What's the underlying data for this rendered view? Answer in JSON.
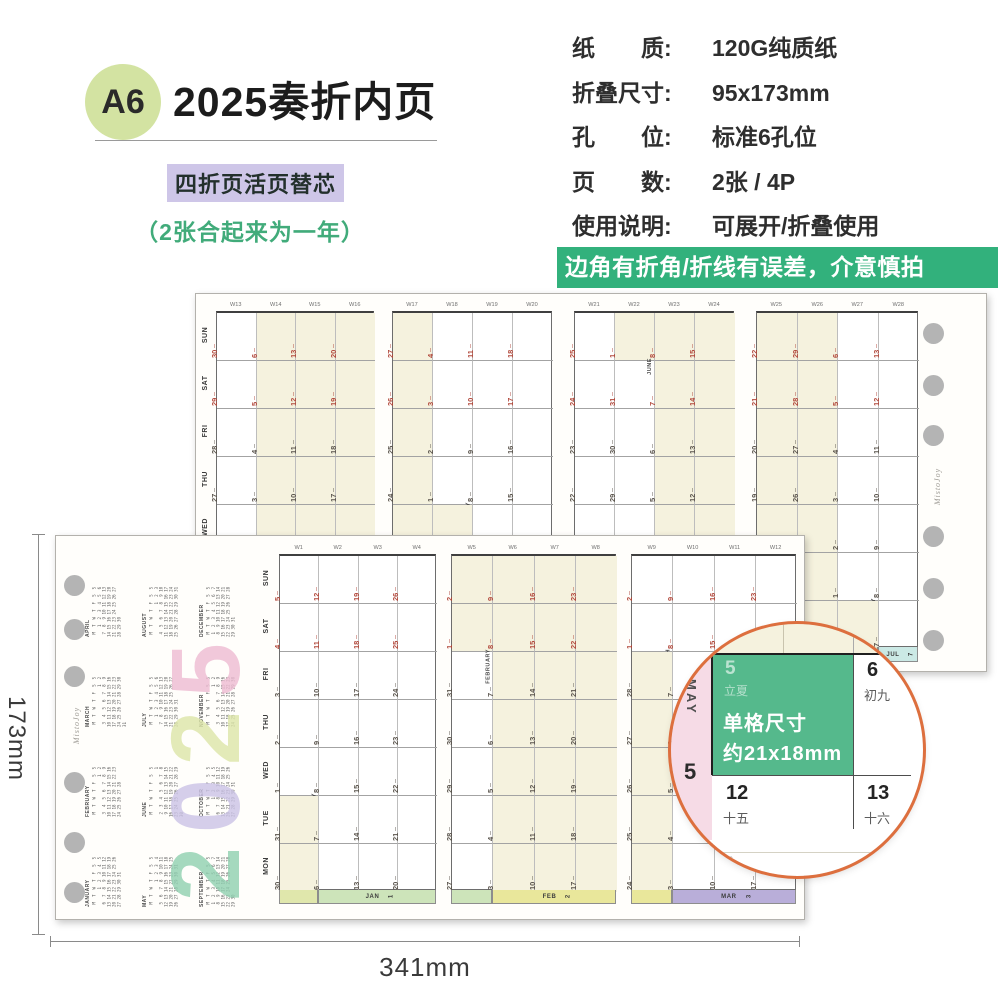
{
  "header": {
    "badge": "A6",
    "badge_bg": "#d3e3a2",
    "title": "2025奏折内页",
    "subtitle": "四折页活页替芯",
    "subtitle_bg": "#cec6e8",
    "note": "（2张合起来为一年）",
    "note_color": "#41ab7a"
  },
  "specs": {
    "rows": [
      {
        "label": "纸　　质:",
        "value": "120G纯质纸"
      },
      {
        "label": "折叠尺寸:",
        "value": "95x173mm"
      },
      {
        "label": "孔　　位:",
        "value": "标准6孔位"
      },
      {
        "label": "页　　数:",
        "value": "2张 / 4P"
      },
      {
        "label": "使用说明:",
        "value": "可展开/折叠使用"
      }
    ],
    "warning": "边角有折角/折线有误差，介意慎拍",
    "warning_bg": "#32b17c"
  },
  "dimensions": {
    "width": "341mm",
    "height": "173mm"
  },
  "brand": "MistoJoy",
  "calendar": {
    "year": 2025,
    "day_rows": [
      "SUN",
      "SAT",
      "FRI",
      "THU",
      "WED",
      "TUE",
      "MON"
    ],
    "month_names": [
      "JANUARY",
      "FEBRUARY",
      "MARCH",
      "APRIL",
      "MAY",
      "JUNE",
      "JULY",
      "AUGUST",
      "SEPTEMBER",
      "OCTOBER",
      "NOVEMBER",
      "DECEMBER"
    ],
    "month_abbr": [
      "JAN",
      "FEB",
      "MAR",
      "APR",
      "MAY",
      "JUN",
      "JUL",
      "AUG",
      "SEP",
      "OCT",
      "NOV",
      "DEC"
    ],
    "weekday_letters": [
      "M",
      "T",
      "W",
      "T",
      "F",
      "S",
      "S"
    ],
    "back_sheet": {
      "week_start": 13,
      "week_end": 28
    },
    "front_sheet": {
      "week_start": 1,
      "week_end": 12
    },
    "band_colors": {
      "JAN": "#cde4ba",
      "FEB": "#e9e79b",
      "MAR": "#b9aed9",
      "APR": "#f0e0c0",
      "MAY": "#f3d4e2",
      "JUN": "#d8e9cc",
      "JUL": "#cbe9e5",
      "AUG": "#f3e0c8",
      "SEP": "#cfe3d8",
      "OCT": "#cec6e8",
      "NOV": "#e4e9c2",
      "DEC": "#e0e7ac"
    },
    "cream": "#f5f2de",
    "date_red": "#b2483b",
    "date_dark": "#5a544c",
    "year_digits": [
      {
        "char": "2",
        "color": "#8fd0b0"
      },
      {
        "char": "0",
        "color": "#cbc3e6"
      },
      {
        "char": "2",
        "color": "#dde6a8"
      },
      {
        "char": "5",
        "color": "#eebbd2"
      }
    ]
  },
  "magnifier": {
    "border_color": "#dd6f3e",
    "band_color": "#f6dbe6",
    "highlight_color": "#55b98c",
    "month_label": "MAY",
    "month_num": "5",
    "caption_line1": "单格尺寸",
    "caption_line2": "约21x18mm",
    "cells": [
      {
        "num": "5",
        "lunar": "立夏"
      },
      {
        "num": "6",
        "lunar": "初九"
      },
      {
        "num": "12",
        "lunar": "十五"
      },
      {
        "num": "13",
        "lunar": "十六"
      }
    ],
    "above": [
      "28",
      "29"
    ],
    "below": [
      "19",
      "20"
    ]
  }
}
